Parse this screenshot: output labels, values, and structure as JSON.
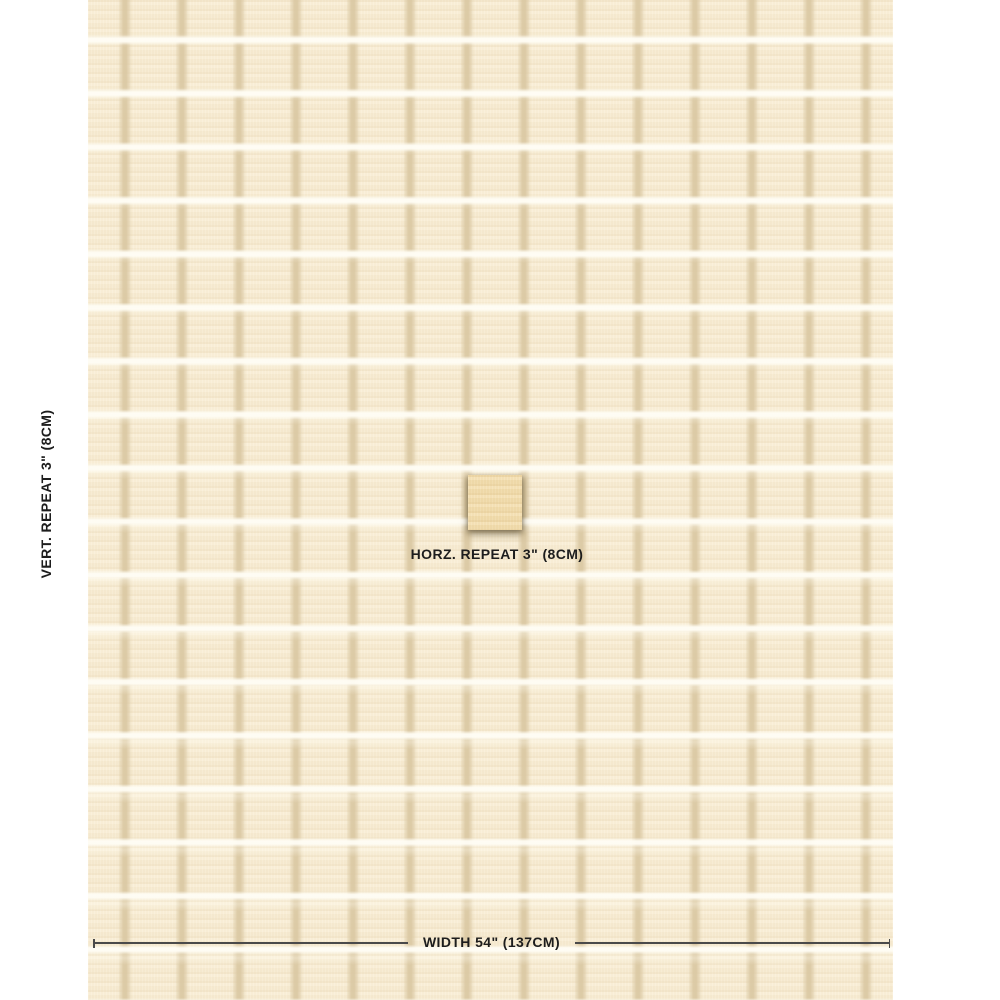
{
  "swatch": {
    "description": "cream windowpane check fabric swatch",
    "base_color": "#f8edd4",
    "vertical_stripe_color": "#dbc9a4",
    "horizontal_stripe_color": "#fffdf5",
    "repeat_square_color": "#f1dbab"
  },
  "labels": {
    "vertical_repeat": "VERT. REPEAT 3\" (8CM)",
    "horizontal_repeat": "HORZ. REPEAT 3\" (8CM)",
    "width": "WIDTH 54\" (137CM)"
  },
  "colors": {
    "text": "#1d1d1d",
    "measure_line": "#4a4a4a",
    "page_background": "#ffffff"
  }
}
